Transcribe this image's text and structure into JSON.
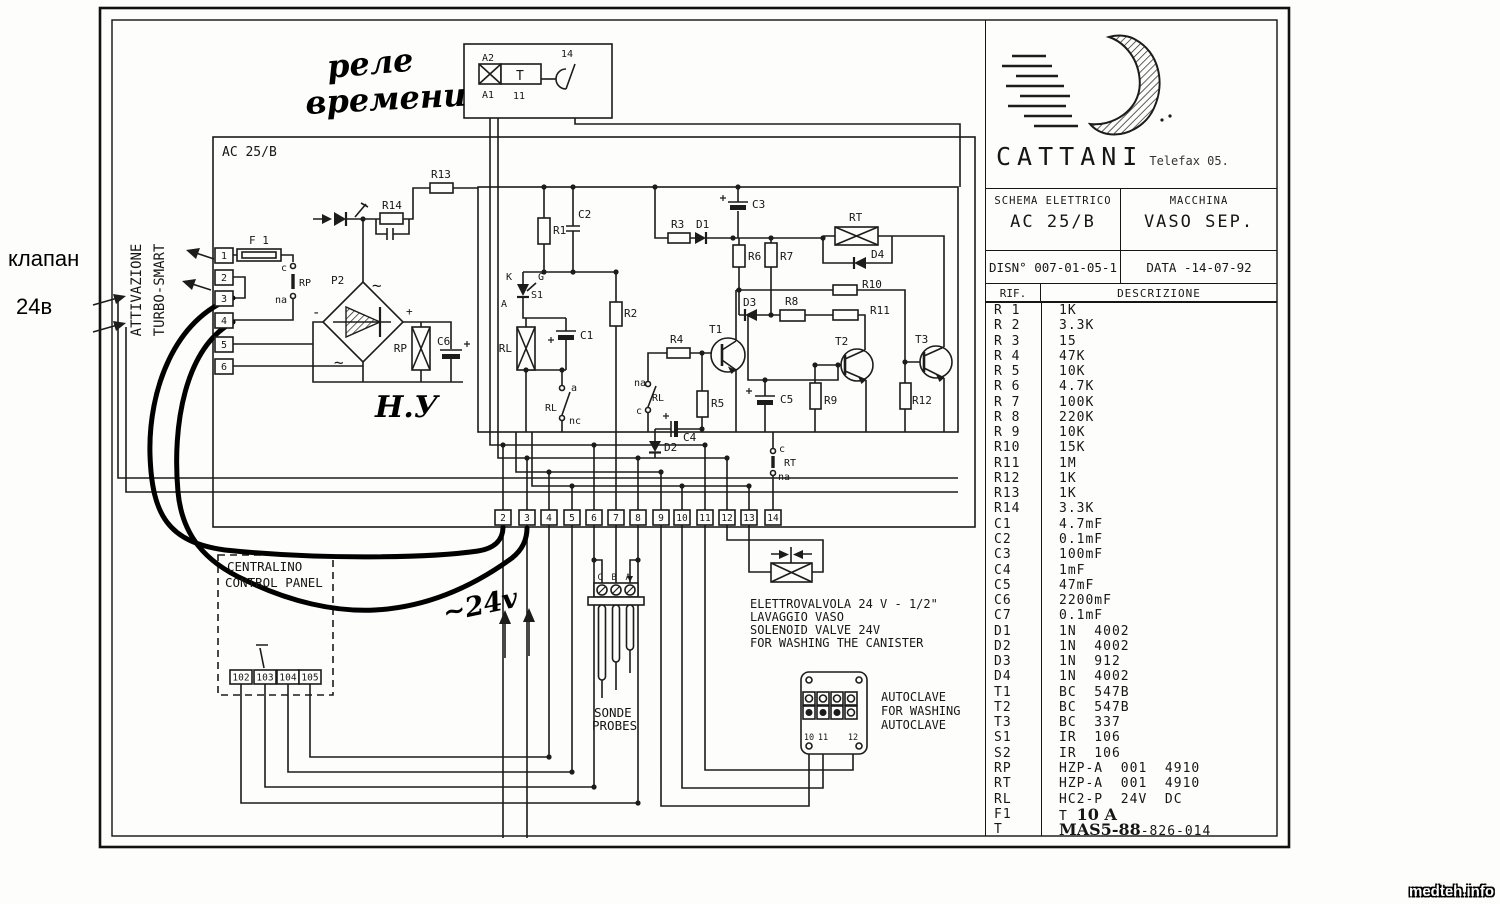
{
  "annotations": {
    "klapan": "клапан",
    "v24b": "24в"
  },
  "watermark": "medteh.info",
  "title_block": {
    "brand": "CATTANI",
    "brand_suffix": "Telefax 05.",
    "schema_label": "SCHEMA ELETTRICO",
    "schema_value": "AC 25/B",
    "machine_label": "MACCHINA",
    "machine_value": "VASO SEP.",
    "drawing_no_label": "DISN°",
    "drawing_no": "007-01-05-1",
    "date_label": "DATA",
    "date_value": "-14-07-92",
    "ref_header": "RIF.",
    "desc_header": "DESCRIZIONE"
  },
  "parts_list": {
    "rows": [
      {
        "ref": "R 1",
        "desc": "1K"
      },
      {
        "ref": "R 2",
        "desc": "3.3K"
      },
      {
        "ref": "R 3",
        "desc": "15"
      },
      {
        "ref": "R 4",
        "desc": "47K"
      },
      {
        "ref": "R 5",
        "desc": "10K"
      },
      {
        "ref": "R 6",
        "desc": "4.7K"
      },
      {
        "ref": "R 7",
        "desc": "100K"
      },
      {
        "ref": "R 8",
        "desc": "220K"
      },
      {
        "ref": "R 9",
        "desc": "10K"
      },
      {
        "ref": "R10",
        "desc": "15K"
      },
      {
        "ref": "R11",
        "desc": "1M"
      },
      {
        "ref": "R12",
        "desc": "1K"
      },
      {
        "ref": "R13",
        "desc": "1K"
      },
      {
        "ref": "R14",
        "desc": "3.3K"
      },
      {
        "ref": "C1",
        "desc": "4.7mF"
      },
      {
        "ref": "C2",
        "desc": "0.1mF"
      },
      {
        "ref": "C3",
        "desc": "100mF"
      },
      {
        "ref": "C4",
        "desc": "1mF"
      },
      {
        "ref": "C5",
        "desc": "47mF"
      },
      {
        "ref": "C6",
        "desc": "2200mF"
      },
      {
        "ref": "C7",
        "desc": "0.1mF"
      },
      {
        "ref": "D1",
        "desc": "1N  4002"
      },
      {
        "ref": "D2",
        "desc": "1N  4002"
      },
      {
        "ref": "D3",
        "desc": "1N  912"
      },
      {
        "ref": "D4",
        "desc": "1N  4002"
      },
      {
        "ref": "T1",
        "desc": "BC  547B"
      },
      {
        "ref": "T2",
        "desc": "BC  547B"
      },
      {
        "ref": "T3",
        "desc": "BC  337"
      },
      {
        "ref": "S1",
        "desc": "IR  106"
      },
      {
        "ref": "S2",
        "desc": "IR  106"
      },
      {
        "ref": "RP",
        "desc": "HZP-A  001  4910"
      },
      {
        "ref": "RT",
        "desc": "HZP-A  001  4910"
      },
      {
        "ref": "RL",
        "desc": "HC2-P  24V  DC"
      },
      {
        "ref": "F1",
        "desc": "T ",
        "hand": "10 A"
      },
      {
        "ref": "T",
        "hand_before": "MAS5-88",
        "desc": "-826-014"
      }
    ]
  },
  "schematic": {
    "labels": [
      {
        "n": "ac-block-label",
        "t": "AC 25/B",
        "x": 222,
        "y": 156,
        "s": 13
      },
      {
        "n": "attivazione-label",
        "t": "ATTIVAZIONE",
        "x": 141,
        "y": 290,
        "s": 14,
        "a": "middle",
        "r": -90
      },
      {
        "n": "turbo-smart-label",
        "t": "TURBO-SMART",
        "x": 164,
        "y": 290,
        "s": 14,
        "a": "middle",
        "r": -90
      },
      {
        "n": "rele-note-line1",
        "t": "реле",
        "x": 328,
        "y": 78,
        "s": 32,
        "h": 1,
        "r": -5
      },
      {
        "n": "rele-note-line2",
        "t": "времени",
        "x": 306,
        "y": 114,
        "s": 32,
        "h": 1,
        "r": -3
      },
      {
        "n": "relay-a2",
        "t": "A2",
        "x": 482,
        "y": 61,
        "s": 10
      },
      {
        "n": "relay-a1",
        "t": "A1",
        "x": 482,
        "y": 98,
        "s": 10
      },
      {
        "n": "relay-t",
        "t": "T",
        "x": 516,
        "y": 80,
        "s": 13
      },
      {
        "n": "relay-11",
        "t": "11",
        "x": 513,
        "y": 99,
        "s": 10
      },
      {
        "n": "relay-14",
        "t": "14",
        "x": 561,
        "y": 57,
        "s": 10
      },
      {
        "n": "f1-label",
        "t": "F 1",
        "x": 249,
        "y": 244,
        "s": 11
      },
      {
        "n": "rp-contact-c",
        "t": "c",
        "x": 287,
        "y": 271,
        "s": 10,
        "a": "end"
      },
      {
        "n": "rp-contact-label",
        "t": "RP",
        "x": 299,
        "y": 286,
        "s": 10
      },
      {
        "n": "rp-contact-na",
        "t": "na",
        "x": 287,
        "y": 303,
        "s": 10,
        "a": "end"
      },
      {
        "n": "p2-label",
        "t": "P2",
        "x": 331,
        "y": 284,
        "s": 11
      },
      {
        "n": "bridge-ac-top",
        "t": "~",
        "x": 372,
        "y": 291,
        "s": 16
      },
      {
        "n": "bridge-ac-bottom",
        "t": "~",
        "x": 334,
        "y": 368,
        "s": 16
      },
      {
        "n": "bridge-minus",
        "t": "-",
        "x": 312,
        "y": 317,
        "s": 14
      },
      {
        "n": "bridge-plus",
        "t": "+",
        "x": 406,
        "y": 315,
        "s": 11
      },
      {
        "n": "rp-coil-label",
        "t": "RP",
        "x": 407,
        "y": 352,
        "s": 11,
        "a": "end"
      },
      {
        "n": "c6-label",
        "t": "C6",
        "x": 437,
        "y": 345,
        "s": 11
      },
      {
        "n": "hy-note",
        "t": "Н.У",
        "x": 375,
        "y": 417,
        "s": 30,
        "h": 1
      },
      {
        "n": "r13-label",
        "t": "R13",
        "x": 431,
        "y": 178,
        "s": 11
      },
      {
        "n": "r14-label",
        "t": "R14",
        "x": 382,
        "y": 209,
        "s": 11
      },
      {
        "n": "r1-label",
        "t": "R1",
        "x": 553,
        "y": 234,
        "s": 11
      },
      {
        "n": "c2-label",
        "t": "C2",
        "x": 578,
        "y": 218,
        "s": 11
      },
      {
        "n": "s1-k",
        "t": "K",
        "x": 512,
        "y": 280,
        "s": 10,
        "a": "end"
      },
      {
        "n": "s1-g",
        "t": "G",
        "x": 538,
        "y": 280,
        "s": 10
      },
      {
        "n": "s1-label",
        "t": "S1",
        "x": 531,
        "y": 298,
        "s": 10
      },
      {
        "n": "s1-a",
        "t": "A",
        "x": 507,
        "y": 307,
        "s": 10,
        "a": "end"
      },
      {
        "n": "rl-coil-label",
        "t": "RL",
        "x": 512,
        "y": 352,
        "s": 11,
        "a": "end"
      },
      {
        "n": "c1-label",
        "t": "C1",
        "x": 580,
        "y": 339,
        "s": 11
      },
      {
        "n": "rl-contact-a",
        "t": "a",
        "x": 571,
        "y": 391,
        "s": 10
      },
      {
        "n": "rl-contact-label",
        "t": "RL",
        "x": 557,
        "y": 411,
        "s": 10,
        "a": "end"
      },
      {
        "n": "rl-contact-nc",
        "t": "nc",
        "x": 569,
        "y": 424,
        "s": 10
      },
      {
        "n": "r2-label",
        "t": "R2",
        "x": 624,
        "y": 317,
        "s": 11
      },
      {
        "n": "r3-label",
        "t": "R3",
        "x": 671,
        "y": 228,
        "s": 11
      },
      {
        "n": "d1-label",
        "t": "D1",
        "x": 696,
        "y": 228,
        "s": 11
      },
      {
        "n": "c3-label",
        "t": "C3",
        "x": 752,
        "y": 208,
        "s": 11
      },
      {
        "n": "rt-coil-label",
        "t": "RT",
        "x": 849,
        "y": 221,
        "s": 11
      },
      {
        "n": "d4-label",
        "t": "D4",
        "x": 871,
        "y": 258,
        "s": 11
      },
      {
        "n": "r6-label",
        "t": "R6",
        "x": 748,
        "y": 260,
        "s": 11
      },
      {
        "n": "r7-label",
        "t": "R7",
        "x": 780,
        "y": 260,
        "s": 11
      },
      {
        "n": "r10-label",
        "t": "R10",
        "x": 862,
        "y": 288,
        "s": 11
      },
      {
        "n": "r11-label",
        "t": "R11",
        "x": 870,
        "y": 314,
        "s": 11
      },
      {
        "n": "d3-label",
        "t": "D3",
        "x": 743,
        "y": 306,
        "s": 11
      },
      {
        "n": "r8-label",
        "t": "R8",
        "x": 785,
        "y": 305,
        "s": 11
      },
      {
        "n": "r4-label",
        "t": "R4",
        "x": 670,
        "y": 343,
        "s": 11
      },
      {
        "n": "t1-label",
        "t": "T1",
        "x": 709,
        "y": 333,
        "s": 11
      },
      {
        "n": "r5-label",
        "t": "R5",
        "x": 711,
        "y": 407,
        "s": 11
      },
      {
        "n": "c5-label",
        "t": "C5",
        "x": 780,
        "y": 403,
        "s": 11
      },
      {
        "n": "na-rl-c-na",
        "t": "na",
        "x": 634,
        "y": 386,
        "s": 10
      },
      {
        "n": "na-rl-c-label",
        "t": "RL",
        "x": 652,
        "y": 401,
        "s": 10
      },
      {
        "n": "na-rl-c-c",
        "t": "c",
        "x": 636,
        "y": 414,
        "s": 10
      },
      {
        "n": "c4-label",
        "t": "C4",
        "x": 683,
        "y": 441,
        "s": 11
      },
      {
        "n": "d2-label",
        "t": "D2",
        "x": 664,
        "y": 451,
        "s": 11
      },
      {
        "n": "t2-label",
        "t": "T2",
        "x": 835,
        "y": 345,
        "s": 11
      },
      {
        "n": "r9-label",
        "t": "R9",
        "x": 824,
        "y": 404,
        "s": 11
      },
      {
        "n": "t3-label",
        "t": "T3",
        "x": 915,
        "y": 343,
        "s": 11
      },
      {
        "n": "r12-label",
        "t": "R12",
        "x": 912,
        "y": 404,
        "s": 11
      },
      {
        "n": "rt-contact-c",
        "t": "c",
        "x": 779,
        "y": 452,
        "s": 10
      },
      {
        "n": "rt-contact-label",
        "t": "RT",
        "x": 784,
        "y": 466,
        "s": 10
      },
      {
        "n": "rt-contact-na",
        "t": "na",
        "x": 778,
        "y": 480,
        "s": 10
      },
      {
        "n": "v24-note",
        "t": "~24v",
        "x": 445,
        "y": 622,
        "s": 27,
        "h": 1,
        "r": -12
      },
      {
        "n": "panel-name-line1",
        "t": "CENTRALINO",
        "x": 227,
        "y": 571,
        "s": 12.5
      },
      {
        "n": "panel-name-line2",
        "t": "CONTROL PANEL",
        "x": 225,
        "y": 587,
        "s": 12.5
      },
      {
        "n": "sonde-caption-line1",
        "t": "SONDE",
        "x": 594,
        "y": 717,
        "s": 12.5
      },
      {
        "n": "sonde-caption-line2",
        "t": "PROBES",
        "x": 592,
        "y": 730,
        "s": 12.5
      },
      {
        "n": "valve-caption-line1",
        "t": "ELETTROVALVOLA 24 V - 1/2\"",
        "x": 750,
        "y": 608,
        "s": 12
      },
      {
        "n": "valve-caption-line2",
        "t": "LAVAGGIO VASO",
        "x": 750,
        "y": 621,
        "s": 12
      },
      {
        "n": "valve-caption-line3",
        "t": "SOLENOID VALVE 24V",
        "x": 750,
        "y": 634,
        "s": 12
      },
      {
        "n": "valve-caption-line4",
        "t": "FOR WASHING THE CANISTER",
        "x": 750,
        "y": 647,
        "s": 12
      },
      {
        "n": "autoclave-caption-line1",
        "t": "AUTOCLAVE",
        "x": 881,
        "y": 701,
        "s": 12
      },
      {
        "n": "autoclave-caption-line2",
        "t": "FOR WASHING",
        "x": 881,
        "y": 715,
        "s": 12
      },
      {
        "n": "autoclave-caption-line3",
        "t": "AUTOCLAVE",
        "x": 881,
        "y": 729,
        "s": 12
      }
    ],
    "left_terminals": [
      {
        "label": "1",
        "y": 248
      },
      {
        "label": "2",
        "y": 270
      },
      {
        "label": "3",
        "y": 291
      },
      {
        "label": "4",
        "y": 313
      },
      {
        "label": "5",
        "y": 337
      },
      {
        "label": "6",
        "y": 359
      }
    ],
    "bottom_terminals": [
      {
        "label": "2",
        "x": 503
      },
      {
        "label": "3",
        "x": 527
      },
      {
        "label": "4",
        "x": 549
      },
      {
        "label": "5",
        "x": 572
      },
      {
        "label": "6",
        "x": 594
      },
      {
        "label": "7",
        "x": 616
      },
      {
        "label": "8",
        "x": 638
      },
      {
        "label": "9",
        "x": 661
      },
      {
        "label": "10",
        "x": 682
      },
      {
        "label": "11",
        "x": 705
      },
      {
        "label": "12",
        "x": 727
      },
      {
        "label": "13",
        "x": 749
      },
      {
        "label": "14",
        "x": 773
      }
    ],
    "panel_terminals": [
      {
        "label": "102",
        "x": 241
      },
      {
        "label": "103",
        "x": 265
      },
      {
        "label": "104",
        "x": 288
      },
      {
        "label": "105",
        "x": 310
      }
    ],
    "autoclave_terminals": [
      {
        "label": "10",
        "x": 809
      },
      {
        "label": "11",
        "x": 823
      },
      {
        "label": "12",
        "x": 853
      }
    ],
    "sonde_contacts": [
      {
        "label": "C",
        "x": 600
      },
      {
        "label": "B",
        "x": 614
      },
      {
        "label": "A",
        "x": 628
      }
    ]
  }
}
